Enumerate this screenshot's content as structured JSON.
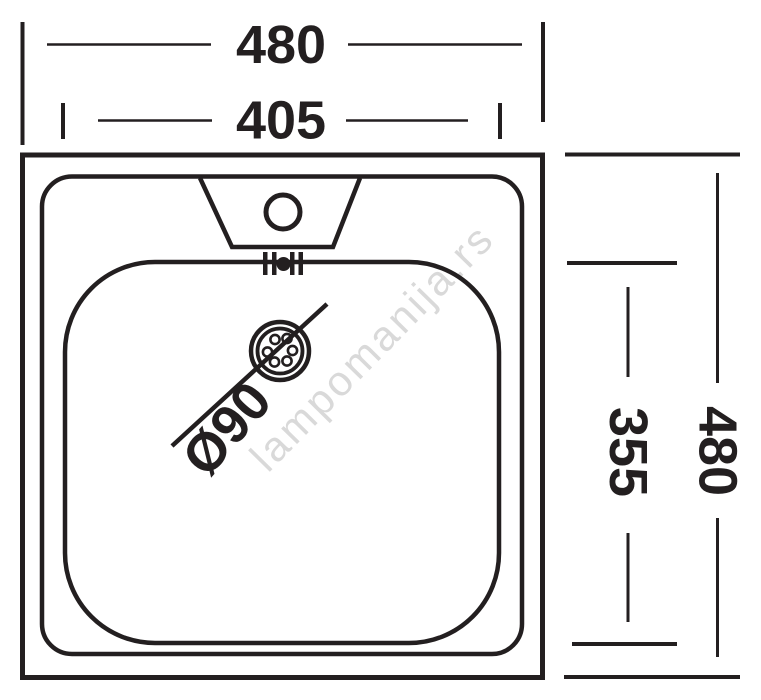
{
  "diagram": {
    "type": "sink-top-view-technical-drawing",
    "watermark": "lampomanija.rs",
    "dimensions": {
      "overall_width": "480",
      "bowl_width": "405",
      "overall_depth": "480",
      "bowl_depth": "355",
      "drain_diameter": "Ø90"
    },
    "colors": {
      "line": "#231f20",
      "watermark": "#d9d9d9",
      "background": "#ffffff"
    }
  }
}
